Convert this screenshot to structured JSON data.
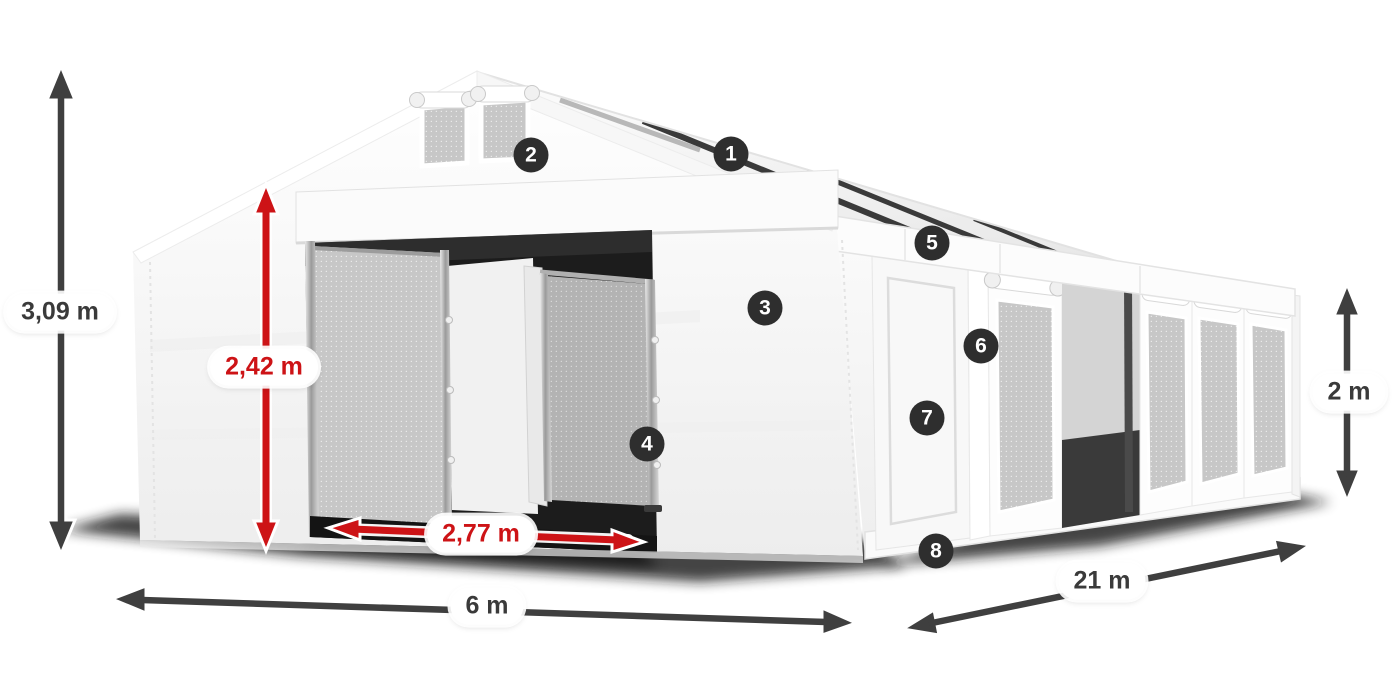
{
  "dimension_labels": [
    {
      "id": "total-height",
      "label": "3,09 m",
      "color": "dark"
    },
    {
      "id": "inner-door-height",
      "label": "2,42 m",
      "color": "red"
    },
    {
      "id": "door-width",
      "label": "2,77 m",
      "color": "red"
    },
    {
      "id": "width",
      "label": "6 m",
      "color": "dark"
    },
    {
      "id": "length",
      "label": "21 m",
      "color": "dark"
    },
    {
      "id": "side-wall-height",
      "label": "2 m",
      "color": "dark"
    }
  ],
  "badges": [
    {
      "number": "1"
    },
    {
      "number": "2"
    },
    {
      "number": "3"
    },
    {
      "number": "4"
    },
    {
      "number": "5"
    },
    {
      "number": "6"
    },
    {
      "number": "7"
    },
    {
      "number": "8"
    }
  ],
  "colors": {
    "dimension_red": "#cd1316",
    "dimension_dark": "#3f3f3f",
    "badge_background": "#2e2e2e",
    "badge_text": "#ffffff",
    "tent_fabric": "#f7f7f7",
    "mesh_panel": "#c5c5c5",
    "roof_strip": "#303030"
  }
}
